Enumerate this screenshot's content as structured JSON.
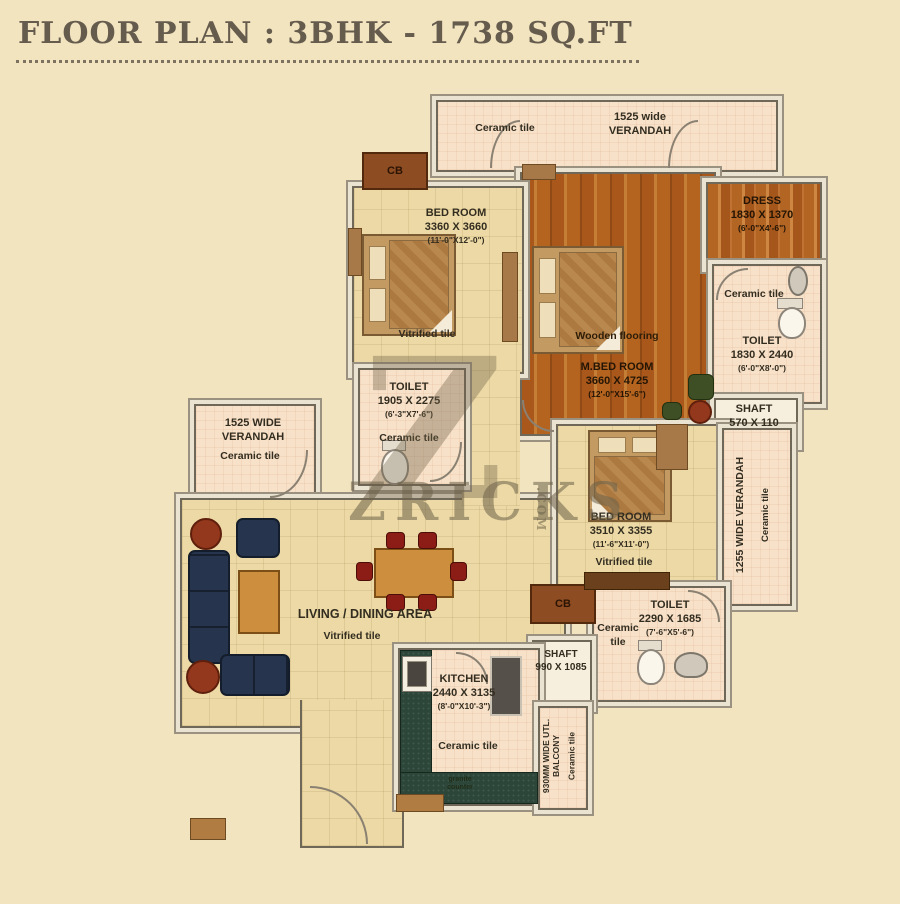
{
  "title": "FLOOR PLAN : 3BHK - 1738 SQ.FT",
  "watermark": {
    "text": "ZRICKS",
    "dotcom": ".COM",
    "z": "Z"
  },
  "rooms": {
    "verandah_top": {
      "size": "1525 wide",
      "name": "VERANDAH",
      "tile": "Ceramic tile"
    },
    "bedroom1": {
      "name": "BED ROOM",
      "mm": "3360 X 3660",
      "ft": "(11'-0\"X12'-0\")",
      "tile": "Vitrified tile"
    },
    "master_bedroom": {
      "floor": "Wooden flooring",
      "name": "M.BED ROOM",
      "mm": "3660 X 4725",
      "ft": "(12'-0\"X15'-6\")"
    },
    "dress": {
      "name": "DRESS",
      "mm": "1830 X 1370",
      "ft": "(6'-0\"X4'-6\")"
    },
    "toilet_master": {
      "name": "TOILET",
      "mm": "1830 X 2440",
      "ft": "(6'-0\"X8'-0\")",
      "tile": "Ceramic tile"
    },
    "shaft_right": {
      "name": "SHAFT",
      "mm": "570 X 110"
    },
    "toilet_common": {
      "name": "TOILET",
      "mm": "1905 X 2275",
      "ft": "(6'-3\"X7'-6\")",
      "tile": "Ceramic tile"
    },
    "verandah_left": {
      "size": "1525 WIDE",
      "name": "VERANDAH",
      "tile": "Ceramic tile"
    },
    "bedroom2": {
      "name": "BED ROOM",
      "mm": "3510 X 3355",
      "ft": "(11'-6\"X11'-0\")",
      "tile": "Vitrified tile"
    },
    "verandah_right": {
      "name": "1255 WIDE VERANDAH",
      "tile": "Ceramic tile"
    },
    "toilet2": {
      "name": "TOILET",
      "mm": "2290 X 1685",
      "ft": "(7'-6\"X5'-6\")",
      "tile": "Ceramic tile"
    },
    "shaft_bottom": {
      "name": "SHAFT",
      "mm": "990 X 1085"
    },
    "kitchen": {
      "name": "KITCHEN",
      "mm": "2440 X 3135",
      "ft": "(8'-0\"X10'-3\")",
      "tile": "Ceramic tile",
      "counter": "granite counter"
    },
    "utility": {
      "name": "930MM WIDE UTL. BALCONY",
      "tile": "Ceramic tile"
    },
    "living": {
      "name": "LIVING / DINING AREA",
      "tile": "Vitrified tile"
    },
    "cb1": {
      "label": "CB"
    },
    "cb2": {
      "label": "CB"
    }
  }
}
